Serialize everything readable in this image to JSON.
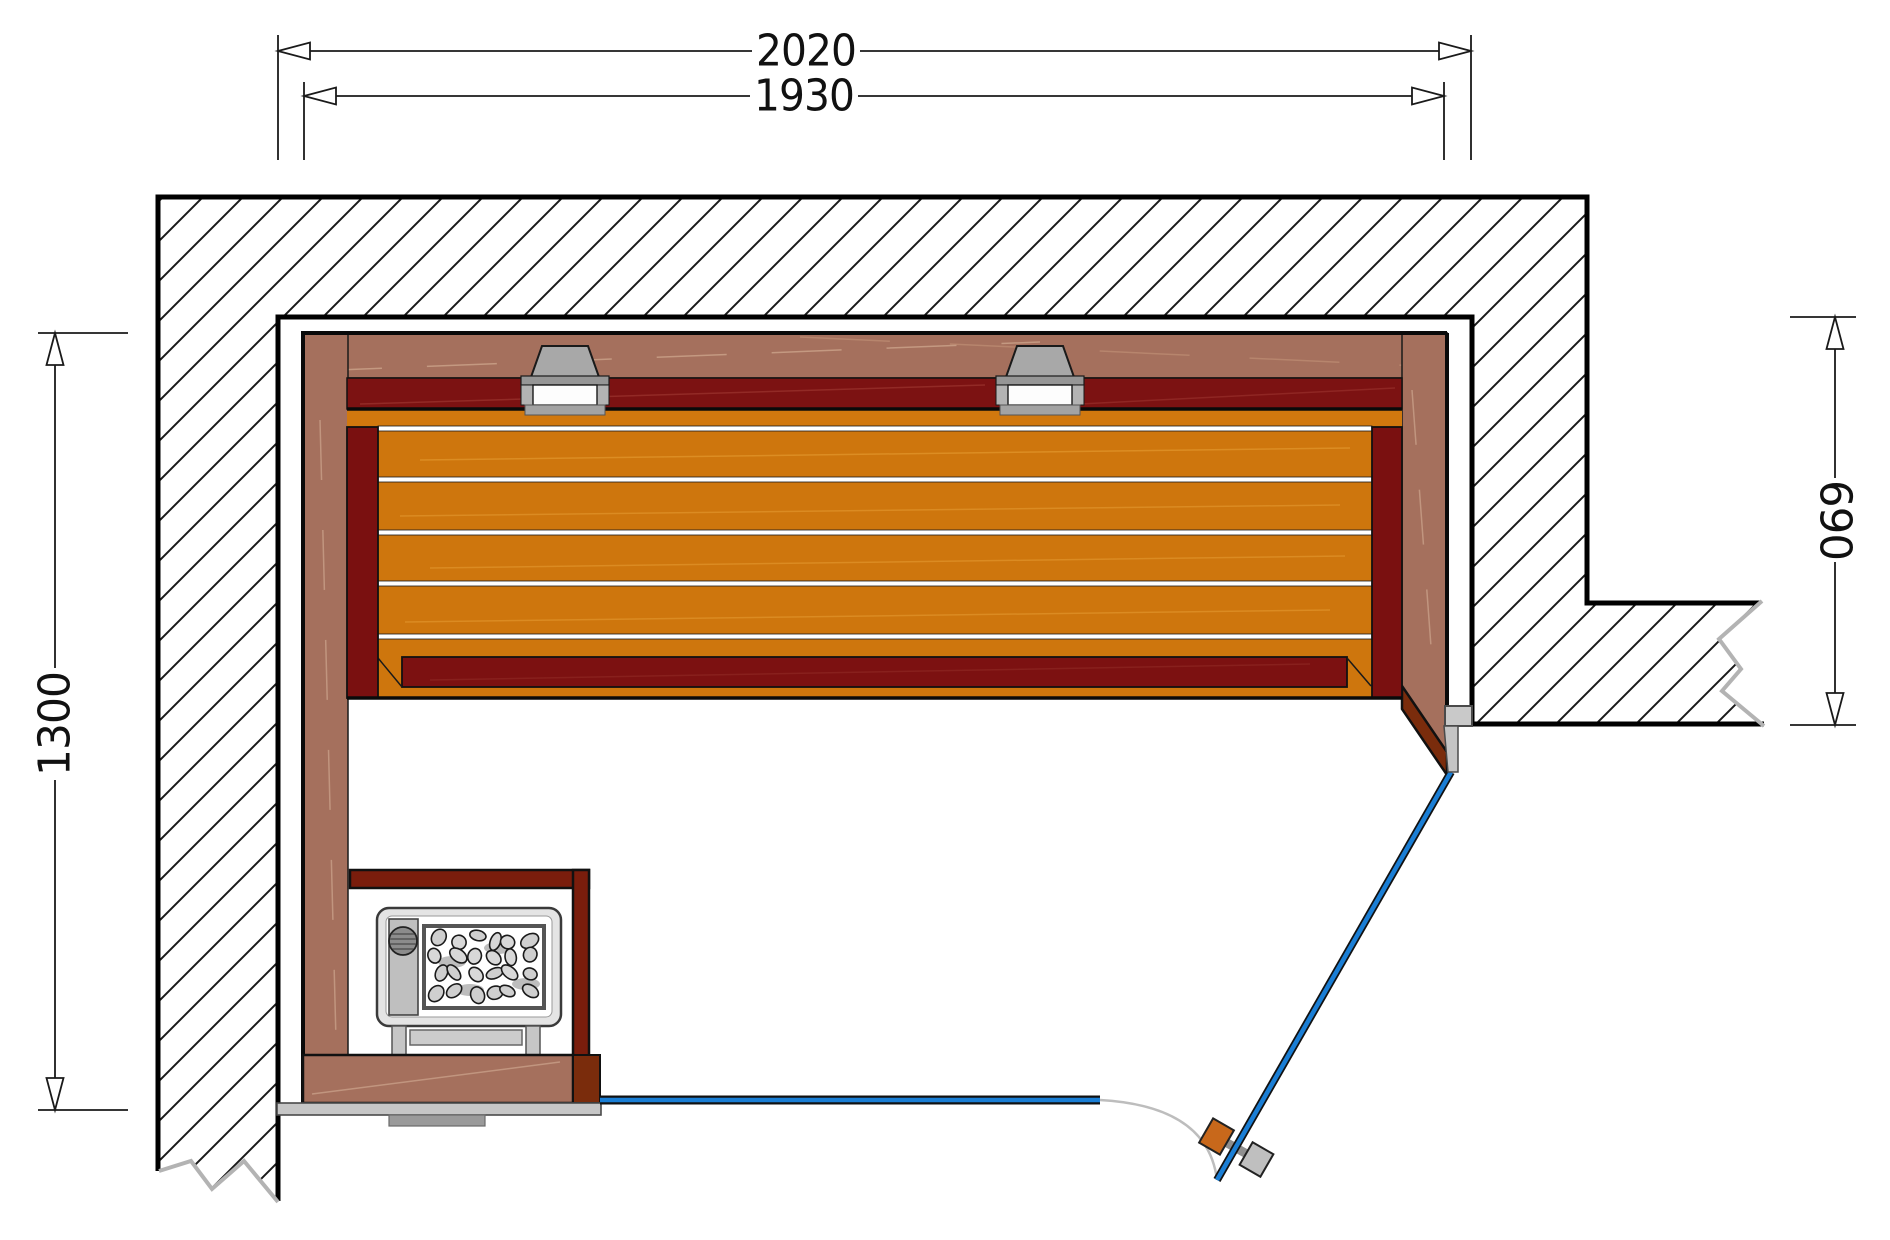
{
  "drawing": {
    "dimensions": {
      "width_outer": "2020",
      "width_inner": "1930",
      "depth": "1300",
      "right_height": "690"
    },
    "colors": {
      "wood_panel": "#A5705D",
      "wood_bench": "#D1780E",
      "wood_dark_red": "#7C1212",
      "wood_jamb": "#7A2C0C",
      "glass_blue": "#1A7ED5",
      "handle_wood": "#C8681B",
      "metal_gray": "#C6C6C6",
      "line_black": "#111111",
      "break_gray": "#B3B3B3"
    }
  }
}
